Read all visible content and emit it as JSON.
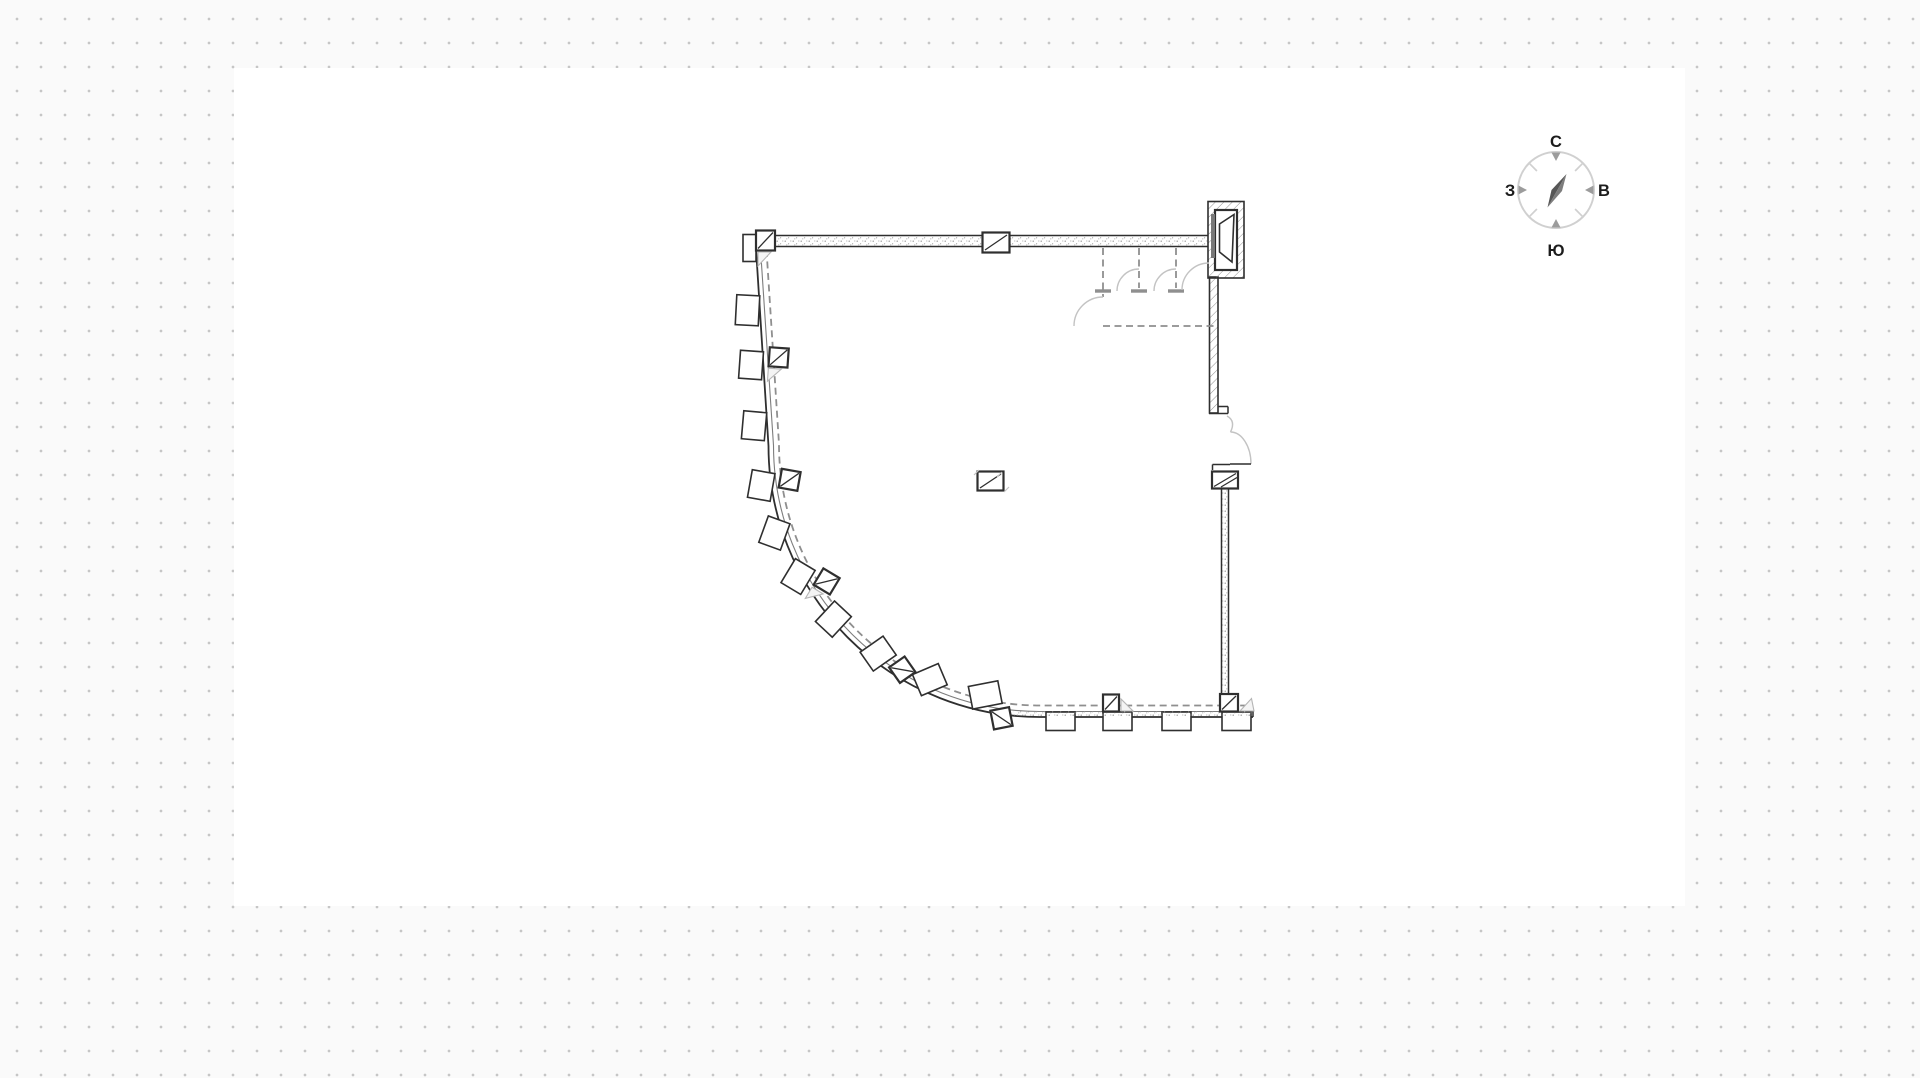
{
  "scene": {
    "kind": "floor-plan-canvas",
    "description": "architectural quarter-round floor plan on dotted grid canvas"
  },
  "colors": {
    "line": "#2f2f2f",
    "mid": "#7d7d7d",
    "dash": "#8f8f8f",
    "arc": "#c3c3c3",
    "hatch": "#8f8f8f",
    "dots": "#c6c6c6",
    "bg": "#fafafa",
    "surface": "#ffffff",
    "ring": "#d0d0d0",
    "tick": "#9c9c9c",
    "needledark": "#565656",
    "needlelight": "#7d7d7d",
    "label": "#1c1c1c",
    "tri": "#b5b5b5"
  },
  "compass": {
    "north": "С",
    "east": "В",
    "south": "Ю",
    "west": "З"
  }
}
